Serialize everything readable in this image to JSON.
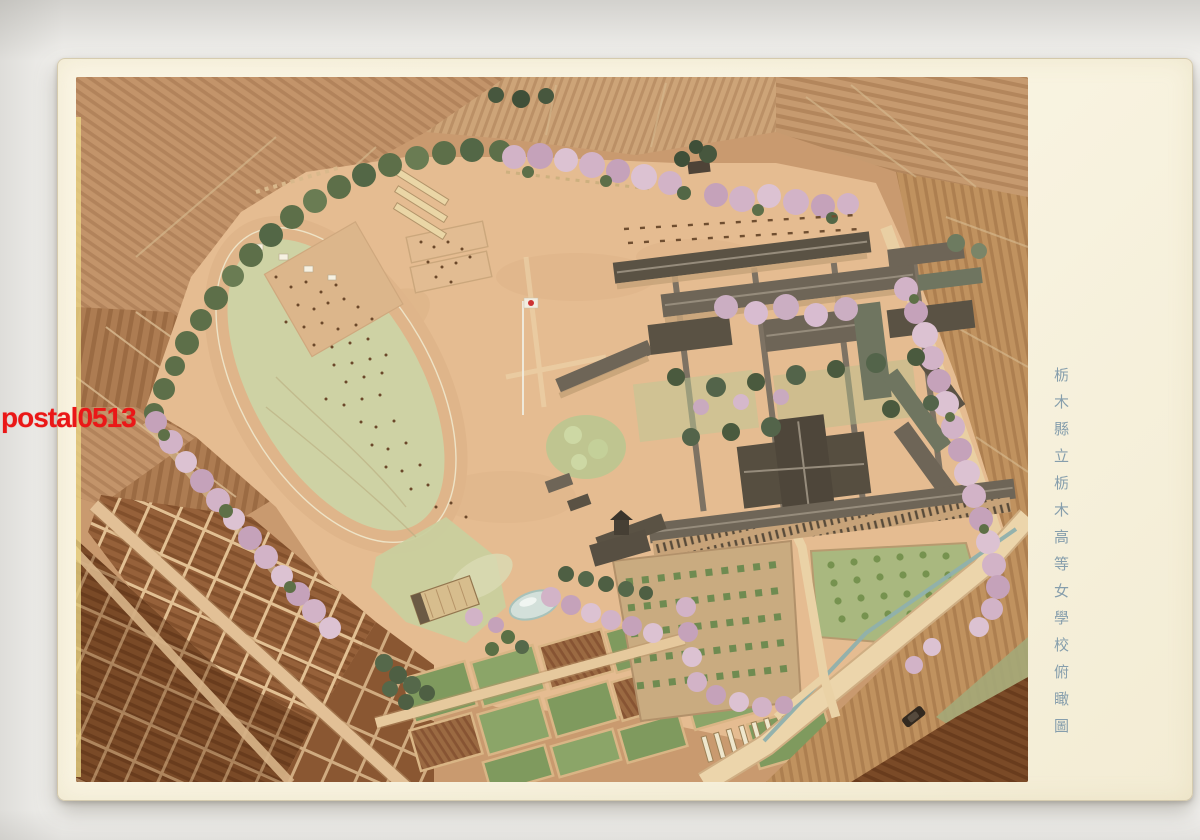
{
  "watermark": {
    "text": "postal0513",
    "color": "#ea1717"
  },
  "caption": {
    "text": "栃木縣立栃木高等女學校俯瞰圖",
    "color": "#7d98a9",
    "orientation": "vertical"
  },
  "palette": {
    "paper_cream": "#f8f3e0",
    "scan_background": "#f3f2ef",
    "ground_salmon": "#e5bc91",
    "farmland_brown": "#c3946a",
    "plot_dark_brown": "#7a4a27",
    "infield_green": "#ced2a4",
    "track_tan": "#dfb58a",
    "garden_green": "#7f9a5e",
    "tree_green": "#5d6f49",
    "cherry_pink": "#d2b3c7",
    "roof_dark": "#5a5244",
    "road_tan": "#e9d0a5",
    "moat_blue": "#8fb0ad",
    "pond_blue": "#d3e0da"
  },
  "scene": {
    "elements": [
      "plowed farmland patchwork",
      "athletic ground with oval track",
      "tennis courts and seed frames",
      "flagpole with Japanese flag",
      "school building complex with courtyards",
      "auditorium with gabled roof",
      "cherry blossom tree lines",
      "vegetable plot grids",
      "garden and orchard plots",
      "small pond",
      "entrance road with moat and car"
    ]
  }
}
